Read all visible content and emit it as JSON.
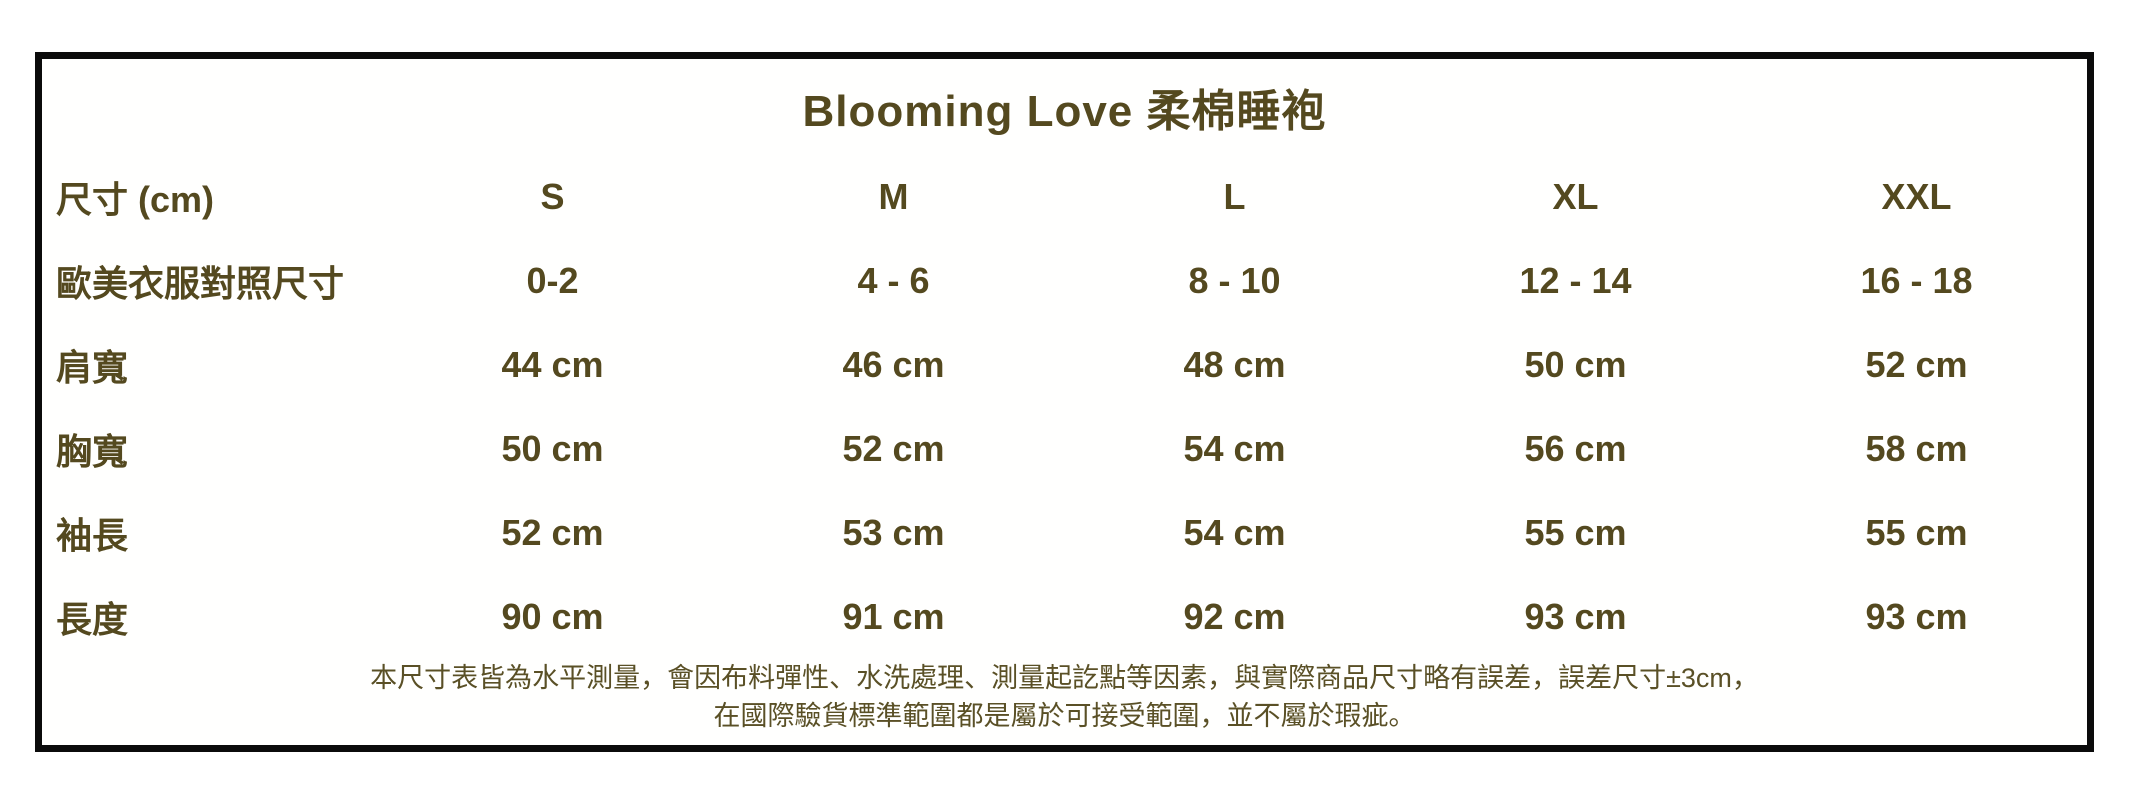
{
  "title": "Blooming Love 柔棉睡袍",
  "colors": {
    "text": "#54491f",
    "border": "#0b0b0b",
    "background": "#ffffff"
  },
  "table": {
    "header": {
      "label": "尺寸 (cm)",
      "sizes": [
        "S",
        "M",
        "L",
        "XL",
        "XXL"
      ]
    },
    "rows": [
      {
        "label": "歐美衣服對照尺寸",
        "values": [
          "0-2",
          "4 - 6",
          "8 - 10",
          "12 - 14",
          "16 - 18"
        ]
      },
      {
        "label": "肩寬",
        "values": [
          "44 cm",
          "46 cm",
          "48 cm",
          "50 cm",
          "52 cm"
        ]
      },
      {
        "label": "胸寬",
        "values": [
          "50 cm",
          "52 cm",
          "54 cm",
          "56 cm",
          "58 cm"
        ]
      },
      {
        "label": "袖長",
        "values": [
          "52 cm",
          "53 cm",
          "54 cm",
          "55 cm",
          "55 cm"
        ]
      },
      {
        "label": "長度",
        "values": [
          "90 cm",
          "91 cm",
          "92 cm",
          "93 cm",
          "93 cm"
        ]
      }
    ]
  },
  "footnotes": [
    "本尺寸表皆為水平測量，會因布料彈性、水洗處理、測量起訖點等因素，與實際商品尺寸略有誤差，誤差尺寸±3cm，",
    "在國際驗貨標準範圍都是屬於可接受範圍，並不屬於瑕疵。"
  ]
}
